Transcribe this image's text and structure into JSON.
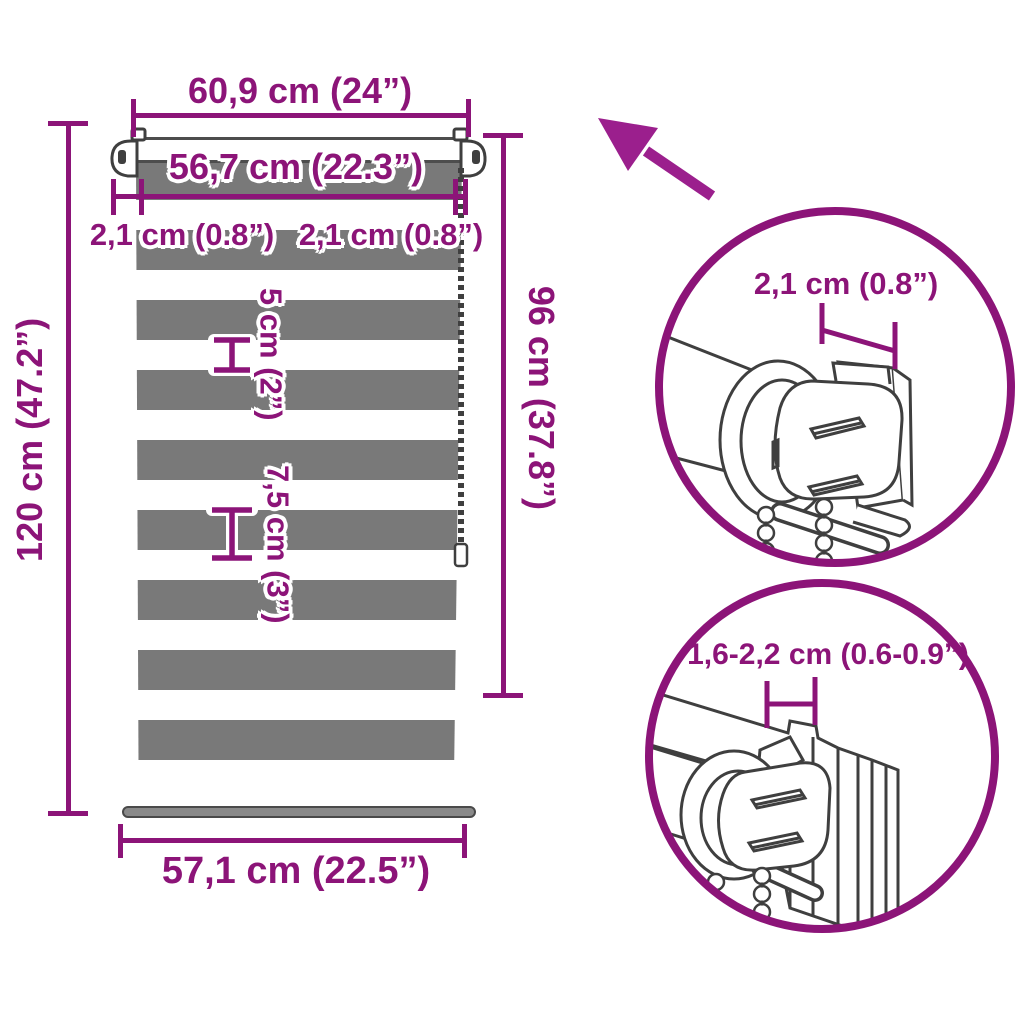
{
  "colors": {
    "accent": "#8C1478",
    "arrow": "#9B1F8D",
    "stripe_gray": "#797979",
    "line_art": "#3F3F3F"
  },
  "blind": {
    "top_width_label": "60,9 cm (24”)",
    "inner_width_label": "56,7 cm (22.3”)",
    "left_offset_label": "2,1 cm (0.8”)",
    "right_offset_label": "2,1 cm (0.8”)",
    "sheer_stripe_label": "5 cm (2”)",
    "opaque_stripe_label": "7,5 cm (3”)",
    "total_height_label": "120 cm (47.2”)",
    "fabric_height_label": "96 cm (37.8”)",
    "bottom_width_label": "57,1 cm (22.5”)"
  },
  "details": {
    "bracket_detail_label": "2,1 cm (0.8”)",
    "clamp_detail_label": "1,6-2,2 cm (0.6-0.9”)"
  },
  "icons": [
    {
      "name": "direction-arrow-icon",
      "meaning": "points toward bracket detail area"
    },
    {
      "name": "bead-chain-icon",
      "meaning": "pull chain of the roller blind"
    }
  ]
}
